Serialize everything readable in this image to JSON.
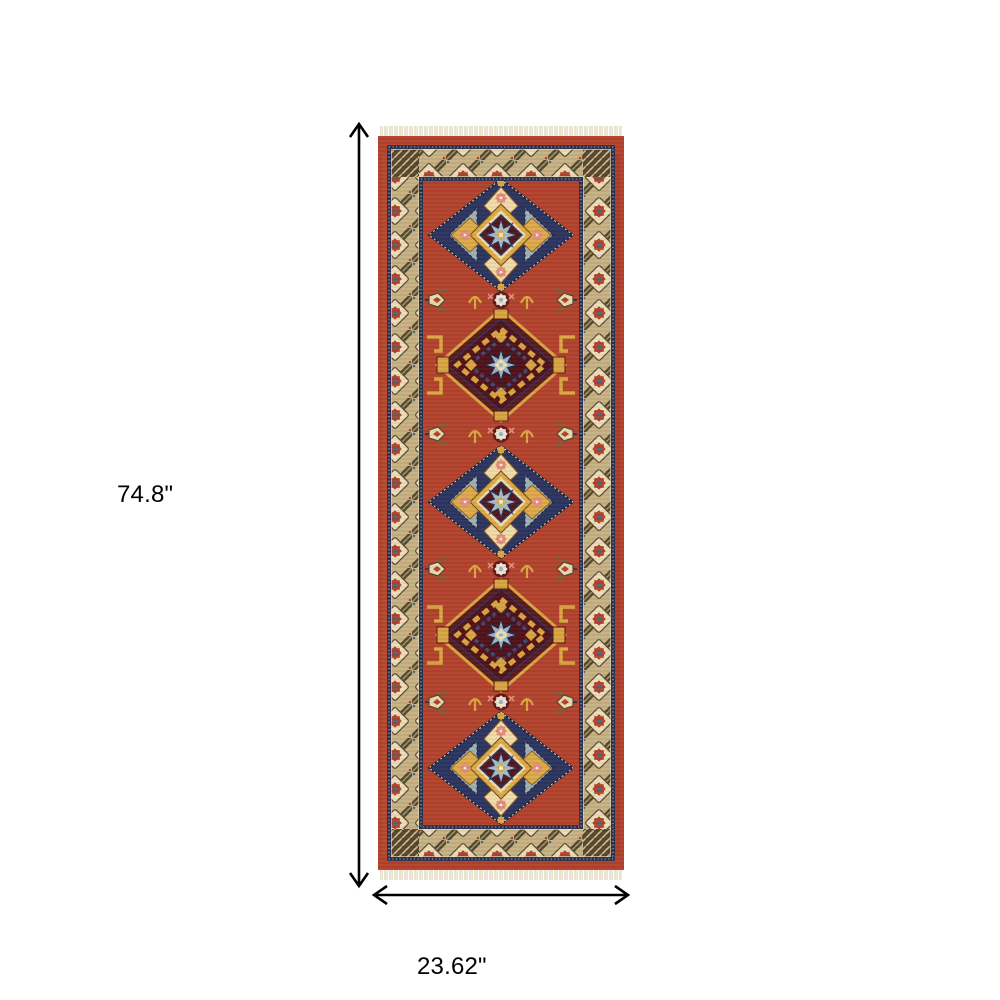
{
  "page": {
    "background": "#ffffff"
  },
  "diagram": {
    "type": "product-dimension-diagram",
    "height_dimension": {
      "label": "74.8\"",
      "orientation": "vertical"
    },
    "width_dimension": {
      "label": "23.62\"",
      "orientation": "horizontal"
    },
    "arrow_color": "#000000",
    "label_color": "#000000"
  },
  "product": {
    "name": "oriental-runner-rug",
    "description": "Red and gold oriental runner rug with five geometric diamond medallions, patterned tan border, navy guard stripes and fringed ends",
    "medallion_count": 5,
    "palette": {
      "field_red": "#b2432d",
      "maroon": "#581416",
      "navy": "#2b3560",
      "gold": "#d9a843",
      "cream": "#efdcab",
      "tan_border": "#c6b285",
      "olive_brown": "#55452f",
      "steel_blue": "#9db5c4",
      "coral": "#e2907a",
      "fringe": "#ece3cc"
    }
  }
}
